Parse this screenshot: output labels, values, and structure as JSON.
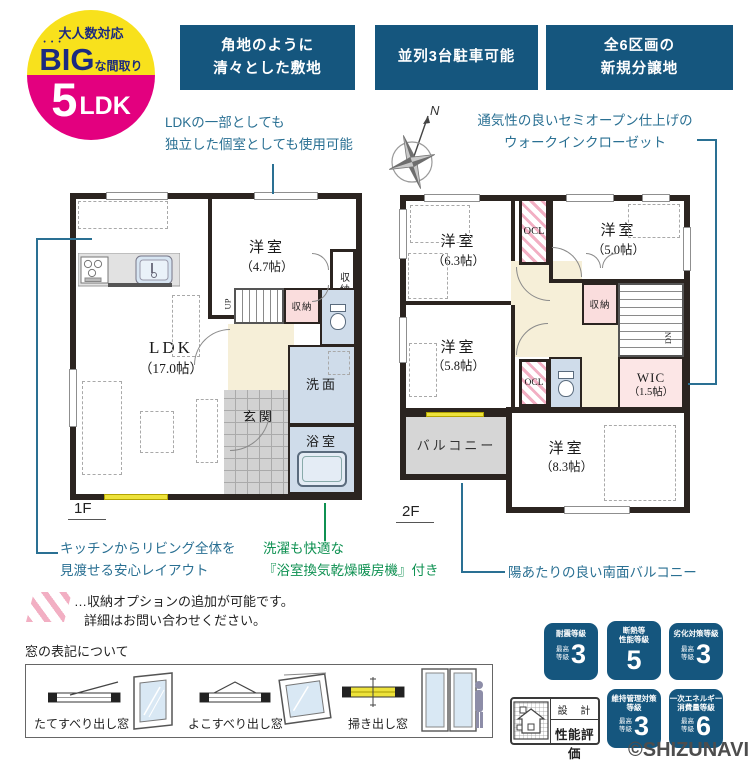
{
  "colors": {
    "navy": "#15567e",
    "teal": "#2a7093",
    "green": "#0f9152",
    "yellow": "#f8e11c",
    "magenta": "#e3007f",
    "pink_hatch": "#f2afc3",
    "wall": "#2b2420",
    "room_blue": "#cfdcea",
    "room_cream": "#f6efd8",
    "room_pink": "#fadddd",
    "balcony_gray": "#d6d6d6",
    "window_yellow": "#ede23b"
  },
  "badge": {
    "top_label": "大人数対応",
    "big": "BIG",
    "big_dots": "•••",
    "big_suffix": "な間取り",
    "number": "5",
    "ldk": "LDK"
  },
  "top_boxes": [
    {
      "line1": "角地のように",
      "line2": "清々とした敷地"
    },
    {
      "line1": "並列3台駐車可能",
      "line2": ""
    },
    {
      "line1": "全6区画の",
      "line2": "新規分譲地"
    }
  ],
  "compass": {
    "label": "N"
  },
  "notes": {
    "flex1": "LDKの一部としても",
    "flex2": "独立した個室としても使用可能",
    "wic1": "通気性の良いセミオープン仕上げの",
    "wic2": "ウォークインクローゼット",
    "kitchen1": "キッチンからリビング全体を",
    "kitchen2": "見渡せる安心レイアウト",
    "bath1": "洗濯も快適な",
    "bath2": "『浴室換気乾燥暖房機』付き",
    "balcony": "陽あたりの良い南面バルコニー",
    "option1": "…収納オプションの追加が可能です。",
    "option2": "詳細はお問い合わせください。"
  },
  "floor1": {
    "label": "1F",
    "ldk_name": "LDK",
    "ldk_size": "（17.0帖）",
    "y47_name": "洋室",
    "y47_size": "（4.7帖）",
    "closet_a": "収納",
    "closet_b": "収納",
    "genkan": "玄関",
    "senmen": "洗面",
    "bath": "浴室",
    "stairs": "UP"
  },
  "floor2": {
    "label": "2F",
    "y63_name": "洋室",
    "y63_size": "（6.3帖）",
    "y50_name": "洋室",
    "y50_size": "（5.0帖）",
    "y58_name": "洋室",
    "y58_size": "（5.8帖）",
    "y83_name": "洋室",
    "y83_size": "（8.3帖）",
    "ocl1": "OCL",
    "ocl2": "OCL",
    "closet": "収納",
    "wic_name": "WIC",
    "wic_size": "（1.5帖）",
    "balcony": "バルコニー",
    "stairs": "DN"
  },
  "legend": {
    "title": "窓の表記について",
    "item1": "たてすべり出し窓",
    "item2": "よこすべり出し窓",
    "item3": "掃き出し窓"
  },
  "performance": {
    "badges": [
      {
        "t1": "耐震等級",
        "t2": "",
        "sub1": "最高",
        "sub2": "等級",
        "value": "3"
      },
      {
        "t1": "断熱等",
        "t2": "性能等級",
        "sub1": "",
        "sub2": "",
        "value": "5"
      },
      {
        "t1": "劣化対策等級",
        "t2": "",
        "sub1": "最高",
        "sub2": "等級",
        "value": "3"
      },
      {
        "t1": "維持管理対策",
        "t2": "等級",
        "sub1": "最高",
        "sub2": "等級",
        "value": "3"
      },
      {
        "t1": "一次エネルギー",
        "t2": "消費量等級",
        "sub1": "最高",
        "sub2": "等級",
        "value": "6"
      }
    ],
    "stamp_top": "設 計",
    "stamp_bottom": "性能評価",
    "copyright": "©SHIZUNAVI"
  }
}
